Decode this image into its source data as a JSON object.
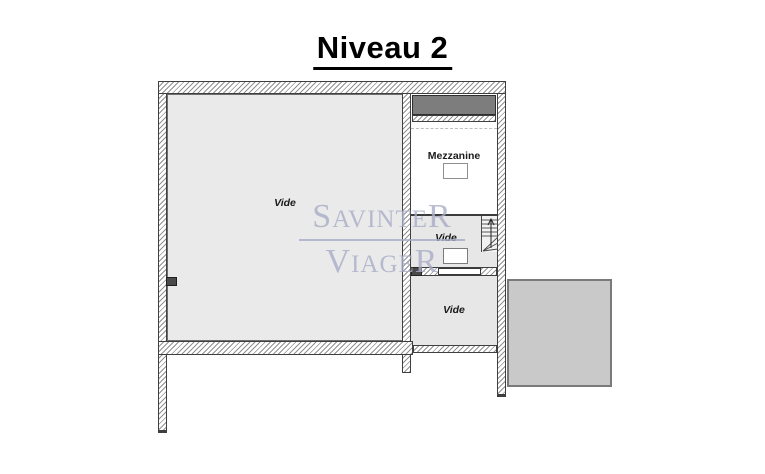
{
  "title": "Niveau 2",
  "watermark": {
    "line1": "SAVINTER",
    "line2": "VIAGER"
  },
  "plan": {
    "large_room": {
      "label": "Vide"
    },
    "mezzanine": {
      "label": "Mezzanine"
    },
    "middle_room": {
      "label": "Vide"
    },
    "bottom_room": {
      "label": "Vide"
    }
  },
  "colors": {
    "title-color": "#000000",
    "label-color": "#1a1a1a",
    "room-fill": "#eaeaea",
    "room-fill-right": "#e7e7e7",
    "wall-hatch": "#909090",
    "wall-border": "#3f3f3f",
    "dark-band": "#7d7d7d",
    "terrace-fill": "#c9c9c9",
    "terrace-border": "#7a7a7a",
    "watermark": "#a9adc6"
  }
}
